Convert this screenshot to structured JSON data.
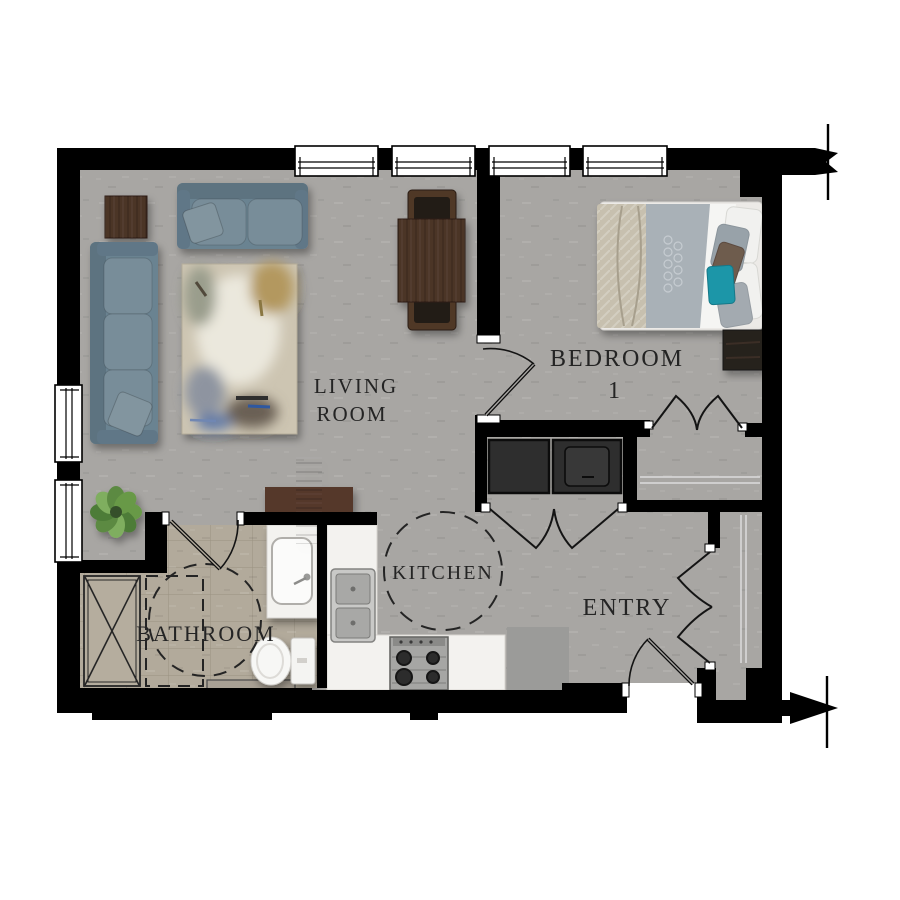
{
  "rooms": {
    "living": {
      "line1": "LIVING",
      "line2": "ROOM"
    },
    "bedroom": {
      "line1": "BEDROOM",
      "line2": "1"
    },
    "kitchen": {
      "label": "KITCHEN"
    },
    "entry": {
      "label": "ENTRY"
    },
    "bathroom": {
      "label": "BATHROOM"
    }
  },
  "colors": {
    "wall": "#000000",
    "floor": "#a8a6a3",
    "bathroom_floor": "#b2aa9b",
    "counter": "#f3f2ef",
    "sofa": "#6b8391",
    "sofa_back": "#5d7380",
    "sofa_cushion": "#788d99",
    "wood_dark": "#4c3528",
    "nightstand": "#27201b",
    "appliance": "#2e2e2e",
    "bed_duvet": "#a9b1b7",
    "bed_throw": "#c7c0af",
    "sheet": "#f5f5f3",
    "accent_teal": "#1d96a8",
    "pillow_brown": "#6e5b4e",
    "plant_green": "#679946",
    "mat": "#9b9b99",
    "label_text": "#242424"
  },
  "furniture": [
    "sofa",
    "loveseat",
    "side-table",
    "area-rug",
    "dining-table",
    "dining-chair",
    "console-table",
    "plant",
    "bed",
    "nightstand",
    "washer",
    "dryer",
    "kitchen-sink",
    "range",
    "entry-mat",
    "vanity-sink",
    "toilet",
    "shower"
  ]
}
